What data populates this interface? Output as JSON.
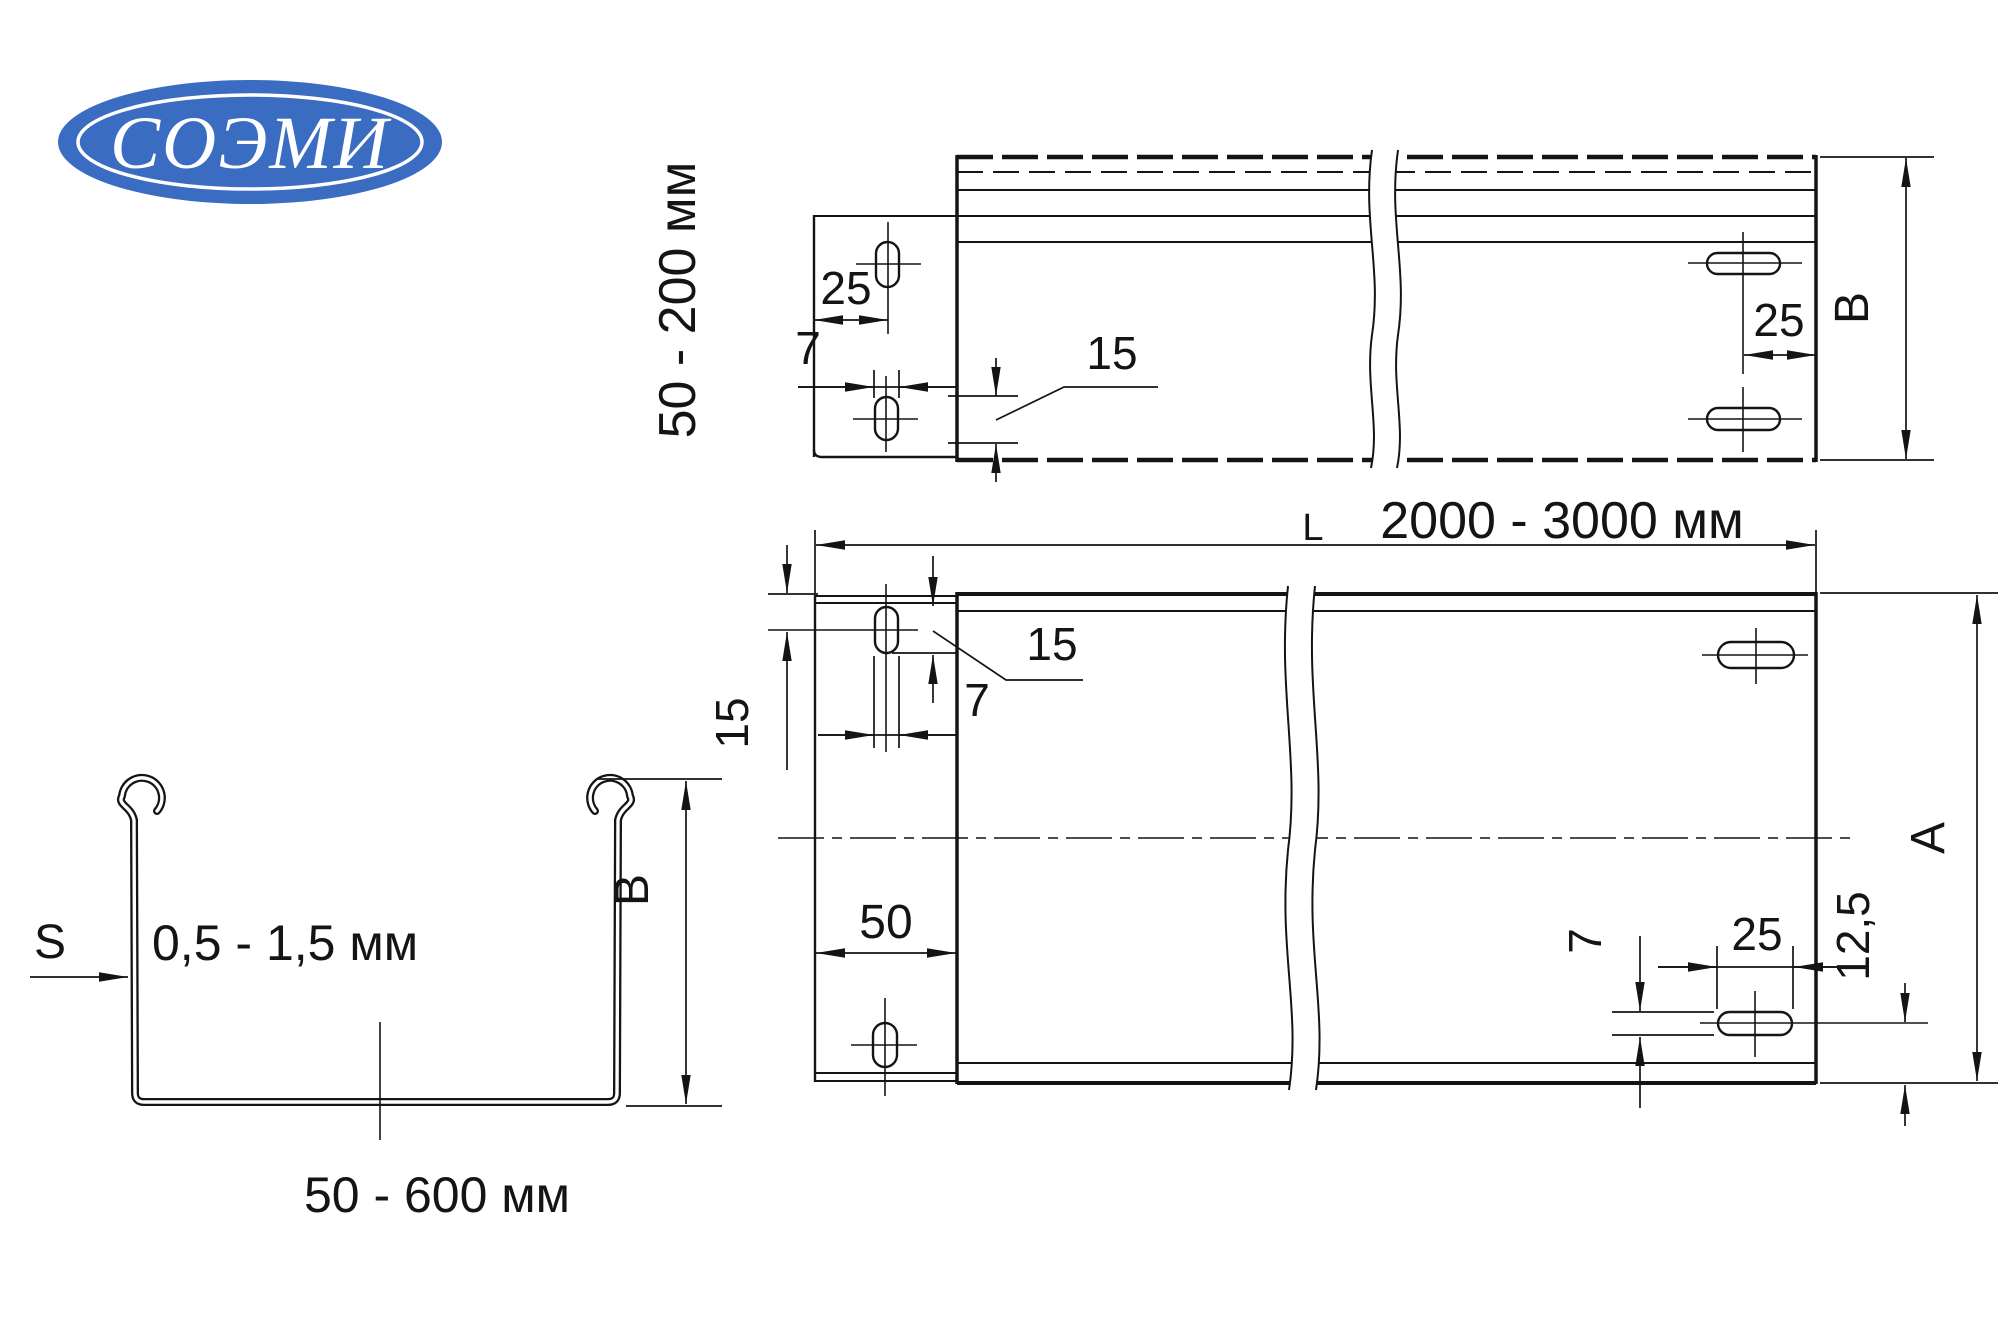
{
  "logo": {
    "text": "СОЭМИ",
    "blue": "#3a6cc2"
  },
  "side_view": {
    "height_range": "50 - 200 мм",
    "dim_hole_to_edge": "25",
    "dim_slot_width": "7",
    "dim_slot_length": "15",
    "dim_end_hole_to_edge": "25",
    "height_letter": "B"
  },
  "length_dim": {
    "letter": "L",
    "range": "2000 - 3000 мм"
  },
  "plan_view": {
    "dim_edge_to_hole_center": "15",
    "dim_slot_length": "15",
    "dim_slot_width": "7",
    "dim_tab_length": "50",
    "dim_end_slot_width": "7",
    "dim_end_slot_length": "25",
    "dim_hole_center_to_edge": "12,5",
    "width_letter": "A"
  },
  "profile_view": {
    "thickness_letter": "S",
    "thickness_range": "0,5 - 1,5 мм",
    "height_letter": "B",
    "width_range": "50 - 600 мм"
  }
}
